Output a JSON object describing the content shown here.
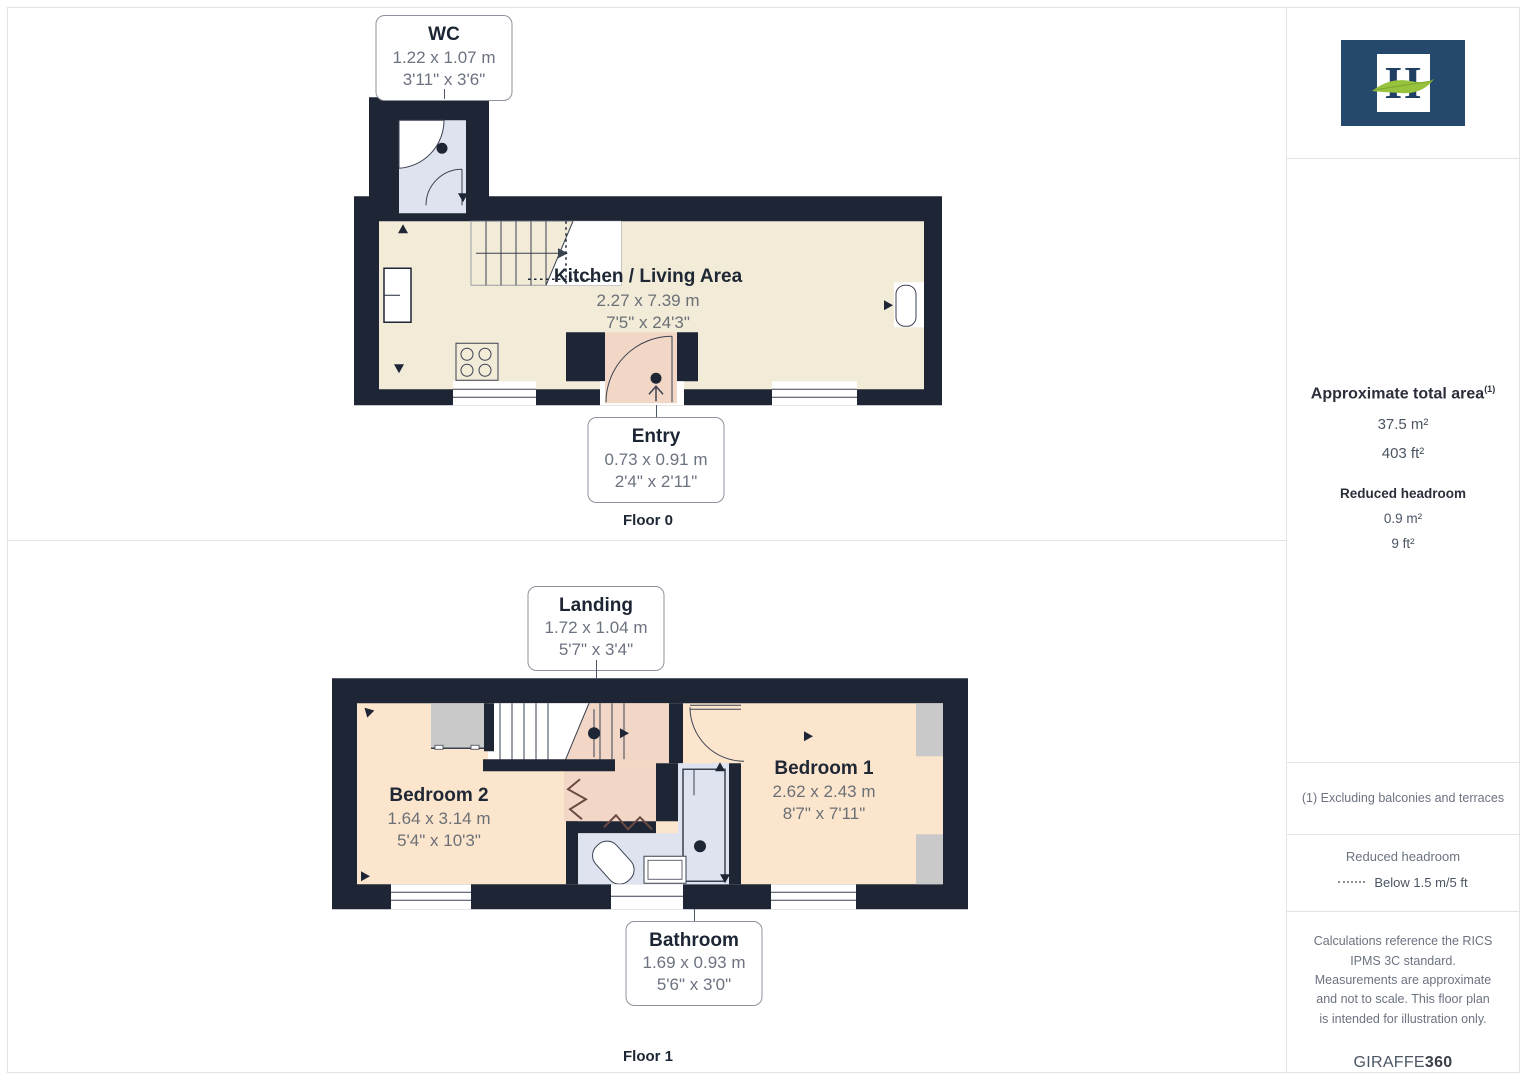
{
  "floors": [
    {
      "title": "Floor 0",
      "rooms": [
        {
          "name": "WC",
          "metric": "1.22 x 1.07 m",
          "imperial": "3'11\" x 3'6\""
        },
        {
          "name": "Kitchen / Living Area",
          "metric": "2.27 x 7.39 m",
          "imperial": "7'5\" x 24'3\""
        },
        {
          "name": "Entry",
          "metric": "0.73 x 0.91 m",
          "imperial": "2'4\" x 2'11\""
        }
      ]
    },
    {
      "title": "Floor 1",
      "rooms": [
        {
          "name": "Landing",
          "metric": "1.72 x 1.04 m",
          "imperial": "5'7\" x 3'4\""
        },
        {
          "name": "Bedroom 2",
          "metric": "1.64 x 3.14 m",
          "imperial": "5'4\" x 10'3\""
        },
        {
          "name": "Bedroom 1",
          "metric": "2.62 x 2.43 m",
          "imperial": "8'7\" x 7'11\""
        },
        {
          "name": "Bathroom",
          "metric": "1.69 x 0.93 m",
          "imperial": "5'6\" x 3'0\""
        }
      ]
    }
  ],
  "sidebar": {
    "logo_letter": "H",
    "total_area": {
      "label": "Approximate total area",
      "footnote_marker": "(1)",
      "metric": "37.5 m²",
      "imperial": "403 ft²"
    },
    "reduced_headroom": {
      "label": "Reduced headroom",
      "metric": "0.9 m²",
      "imperial": "9 ft²"
    },
    "footnote": "(1) Excluding balconies and terraces",
    "legend": {
      "title": "Reduced headroom",
      "item": "Below 1.5 m/5 ft"
    },
    "disclaimer": "Calculations reference the RICS IPMS 3C standard. Measurements are approximate and not to scale. This floor plan is intended for illustration only.",
    "brand": {
      "name": "GIRAFFE",
      "suffix": "360"
    }
  },
  "colors": {
    "wall": "#1e2636",
    "floor_cream": "#f1ebd8",
    "floor_peach": "#fce5cd",
    "floor_pink": "#f3d7c6",
    "floor_blue": "#dee3ef",
    "reduced_grey": "#c9c9c9",
    "logo_navy": "#25496d",
    "logo_green": "#96c23d"
  }
}
